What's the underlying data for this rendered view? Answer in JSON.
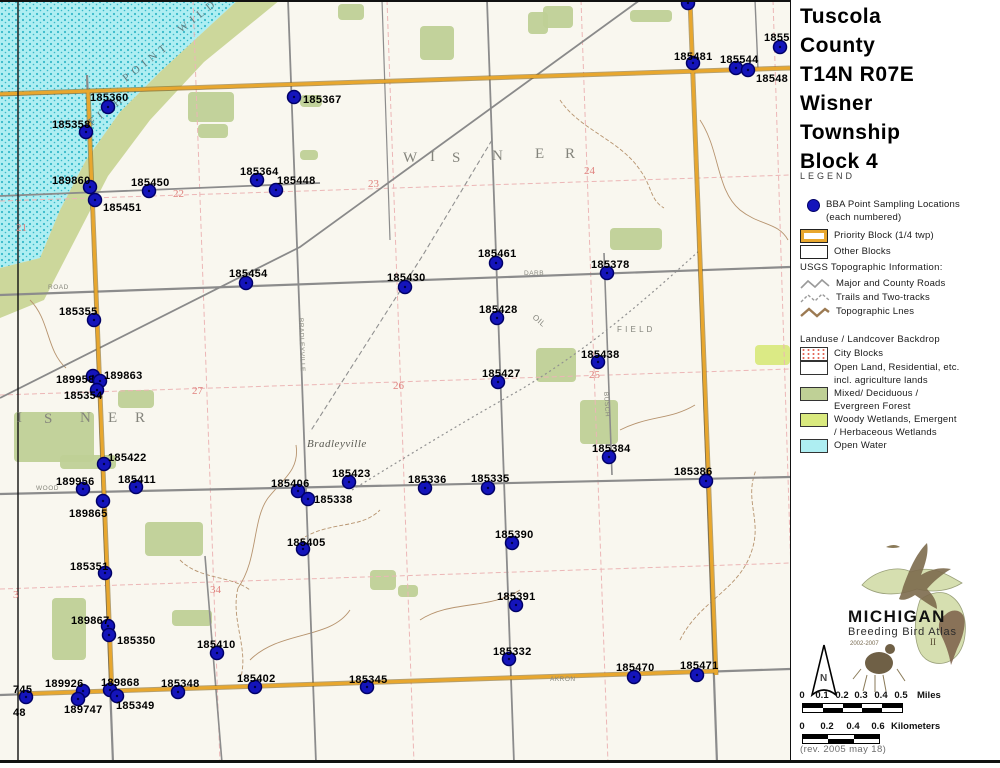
{
  "title": {
    "lines": [
      "Tuscola",
      "County",
      "T14N R07E",
      "Wisner",
      "Township",
      "Block 4"
    ]
  },
  "legend": {
    "heading": "LEGEND",
    "bba": {
      "l1": "BBA Point Sampling Locations",
      "l2": "(each numbered)"
    },
    "priority": "Priority Block (1/4 twp)",
    "other": "Other Blocks",
    "usgs": {
      "heading": "USGS Topographic Information:",
      "roads": "Major and County Roads",
      "trails": "Trails and Two-tracks",
      "topo": "Topographic Lnes"
    },
    "land": {
      "heading": "Landuse / Landcover Backdrop",
      "city": "City Blocks",
      "open1": "Open Land, Residential, etc.",
      "open2": "incl. agriculture lands",
      "mixed1": "Mixed/ Deciduous /",
      "mixed2": "Evergreen Forest",
      "woody1": "Woody Wetlands, Emergent",
      "woody2": "/ Herbaceous Wetlands",
      "water": "Open Water"
    }
  },
  "colors": {
    "dot": "#1414bb",
    "priority_border": "#e8a72e",
    "forest": "#bfd096",
    "wetland": "#d9e97e",
    "water": "#aeeef2"
  },
  "logo": {
    "name": "MICHIGAN",
    "sub": "Breeding Bird Atlas",
    "years": "2002-2007",
    "edition": "II"
  },
  "north": {
    "label": "N"
  },
  "scale": {
    "miles": {
      "labels": [
        "0",
        "0.1",
        "0.2",
        "0.3",
        "0.4",
        "0.5"
      ],
      "unit": "Miles"
    },
    "km": {
      "labels": [
        "0",
        "0.2",
        "0.4",
        "0.6"
      ],
      "unit": "Kilometers"
    }
  },
  "revision": "(rev. 2005 may 18)",
  "map": {
    "points": [
      {
        "id": "185360",
        "x": 108,
        "y": 107,
        "lx": 90,
        "ly": 101
      },
      {
        "id": "185358",
        "x": 86,
        "y": 132,
        "lx": 52,
        "ly": 128
      },
      {
        "id": "189860",
        "x": 90,
        "y": 187,
        "lx": 52,
        "ly": 184
      },
      {
        "id": "185450",
        "x": 149,
        "y": 191,
        "lx": 131,
        "ly": 186
      },
      {
        "id": "185451",
        "x": 95,
        "y": 200,
        "lx": 103,
        "ly": 211
      },
      {
        "id": "185364",
        "x": 257,
        "y": 180,
        "lx": 240,
        "ly": 175
      },
      {
        "id": "185448",
        "x": 276,
        "y": 190,
        "lx": 277,
        "ly": 184
      },
      {
        "id": "185367",
        "x": 294,
        "y": 97,
        "lx": 303,
        "ly": 103
      },
      {
        "id": "",
        "x": 688,
        "y": 3
      },
      {
        "id": "185481",
        "x": 693,
        "y": 63,
        "lx": 674,
        "ly": 60
      },
      {
        "id": "185544",
        "x": 736,
        "y": 68,
        "lx": 720,
        "ly": 63
      },
      {
        "id": "1855",
        "x": 780,
        "y": 47,
        "lx": 764,
        "ly": 41
      },
      {
        "id": "18548",
        "x": 748,
        "y": 70,
        "lx": 756,
        "ly": 82
      },
      {
        "id": "185454",
        "x": 246,
        "y": 283,
        "lx": 229,
        "ly": 277
      },
      {
        "id": "185355",
        "x": 94,
        "y": 320,
        "lx": 59,
        "ly": 315
      },
      {
        "id": "189958",
        "x": 93,
        "y": 376,
        "lx": 56,
        "ly": 383
      },
      {
        "id": "189863",
        "x": 100,
        "y": 381,
        "lx": 104,
        "ly": 379
      },
      {
        "id": "185354",
        "x": 97,
        "y": 390,
        "lx": 64,
        "ly": 399
      },
      {
        "id": "185422",
        "x": 104,
        "y": 464,
        "lx": 108,
        "ly": 461
      },
      {
        "id": "189956",
        "x": 83,
        "y": 489,
        "lx": 56,
        "ly": 485
      },
      {
        "id": "185411",
        "x": 136,
        "y": 487,
        "lx": 118,
        "ly": 483
      },
      {
        "id": "189865",
        "x": 103,
        "y": 501,
        "lx": 69,
        "ly": 517
      },
      {
        "id": "185406",
        "x": 298,
        "y": 491,
        "lx": 271,
        "ly": 487
      },
      {
        "id": "185338",
        "x": 308,
        "y": 499,
        "lx": 314,
        "ly": 503
      },
      {
        "id": "185405",
        "x": 303,
        "y": 549,
        "lx": 287,
        "ly": 546
      },
      {
        "id": "185351",
        "x": 105,
        "y": 573,
        "lx": 70,
        "ly": 570
      },
      {
        "id": "185423",
        "x": 349,
        "y": 482,
        "lx": 332,
        "ly": 477
      },
      {
        "id": "185336",
        "x": 425,
        "y": 488,
        "lx": 408,
        "ly": 483
      },
      {
        "id": "185335",
        "x": 488,
        "y": 488,
        "lx": 471,
        "ly": 482
      },
      {
        "id": "185390",
        "x": 512,
        "y": 543,
        "lx": 495,
        "ly": 538
      },
      {
        "id": "185391",
        "x": 516,
        "y": 605,
        "lx": 497,
        "ly": 600
      },
      {
        "id": "185332",
        "x": 509,
        "y": 659,
        "lx": 493,
        "ly": 655
      },
      {
        "id": "185345",
        "x": 367,
        "y": 687,
        "lx": 349,
        "ly": 683
      },
      {
        "id": "185348",
        "x": 178,
        "y": 692,
        "lx": 161,
        "ly": 687
      },
      {
        "id": "185402",
        "x": 255,
        "y": 687,
        "lx": 237,
        "ly": 682
      },
      {
        "id": "189926",
        "x": 83,
        "y": 691,
        "lx": 45,
        "ly": 687
      },
      {
        "id": "189868",
        "x": 110,
        "y": 690,
        "lx": 101,
        "ly": 686
      },
      {
        "id": "185349",
        "x": 117,
        "y": 696,
        "lx": 116,
        "ly": 709
      },
      {
        "id": "189747",
        "x": 78,
        "y": 699,
        "lx": 64,
        "ly": 713
      },
      {
        "id": "745",
        "x": 26,
        "y": 697,
        "lx": 13,
        "ly": 693
      },
      {
        "id": "48",
        "lx": 13,
        "ly": 716
      },
      {
        "id": "185410",
        "x": 217,
        "y": 653,
        "lx": 197,
        "ly": 648
      },
      {
        "id": "189867",
        "x": 108,
        "y": 626,
        "lx": 71,
        "ly": 624
      },
      {
        "id": "185350",
        "x": 109,
        "y": 635,
        "lx": 117,
        "ly": 644
      },
      {
        "id": "185378",
        "x": 607,
        "y": 273,
        "lx": 591,
        "ly": 268
      },
      {
        "id": "185461",
        "x": 496,
        "y": 263,
        "lx": 478,
        "ly": 257
      },
      {
        "id": "185430",
        "x": 405,
        "y": 287,
        "lx": 387,
        "ly": 281
      },
      {
        "id": "185428",
        "x": 497,
        "y": 318,
        "lx": 479,
        "ly": 313
      },
      {
        "id": "185427",
        "x": 498,
        "y": 382,
        "lx": 482,
        "ly": 377
      },
      {
        "id": "185438",
        "x": 598,
        "y": 362,
        "lx": 581,
        "ly": 358
      },
      {
        "id": "185384",
        "x": 609,
        "y": 457,
        "lx": 592,
        "ly": 452
      },
      {
        "id": "185386",
        "x": 706,
        "y": 481,
        "lx": 674,
        "ly": 475
      },
      {
        "id": "185470",
        "x": 634,
        "y": 677,
        "lx": 616,
        "ly": 671
      },
      {
        "id": "185471",
        "x": 697,
        "y": 675,
        "lx": 680,
        "ly": 669
      }
    ],
    "texts": [
      {
        "t": "W",
        "x": 403,
        "y": 162,
        "cls": "bigname"
      },
      {
        "t": "I",
        "x": 430,
        "y": 161,
        "cls": "bigname"
      },
      {
        "t": "S",
        "x": 452,
        "y": 162,
        "cls": "bigname"
      },
      {
        "t": "N",
        "x": 492,
        "y": 160,
        "cls": "bigname"
      },
      {
        "t": "E",
        "x": 535,
        "y": 158,
        "cls": "bigname"
      },
      {
        "t": "R",
        "x": 565,
        "y": 158,
        "cls": "bigname"
      },
      {
        "t": "I",
        "x": 17,
        "y": 422,
        "cls": "bigname"
      },
      {
        "t": "S",
        "x": 44,
        "y": 423,
        "cls": "bigname"
      },
      {
        "t": "N",
        "x": 80,
        "y": 422,
        "cls": "bigname"
      },
      {
        "t": "E",
        "x": 108,
        "y": 422,
        "cls": "bigname"
      },
      {
        "t": "R",
        "x": 135,
        "y": 422,
        "cls": "bigname"
      },
      {
        "t": "Bradleyville",
        "x": 307,
        "y": 447,
        "cls": "town"
      },
      {
        "t": "F I E L D",
        "x": 617,
        "y": 332,
        "cls": "micro2"
      },
      {
        "t": "OIL",
        "x": 532,
        "y": 318,
        "cls": "micro2",
        "rot": 40
      },
      {
        "t": "WOOD",
        "x": 36,
        "y": 490,
        "cls": "micro"
      },
      {
        "t": "ROAD",
        "x": 48,
        "y": 289,
        "cls": "micro"
      },
      {
        "t": "AKRON",
        "x": 550,
        "y": 681,
        "cls": "micro"
      },
      {
        "t": "DARB",
        "x": 524,
        "y": 275,
        "cls": "micro"
      },
      {
        "t": "BRADLEYVILLE",
        "x": 299,
        "y": 318,
        "cls": "micro",
        "rot": 88
      },
      {
        "t": "BUSCH",
        "x": 604,
        "y": 392,
        "cls": "micro",
        "rot": 86
      },
      {
        "t": "FISH",
        "x": 92,
        "y": 126,
        "cls": "shore",
        "rot": -38
      },
      {
        "t": "POINT",
        "x": 126,
        "y": 82,
        "cls": "shore",
        "rot": -38
      },
      {
        "t": "WILD",
        "x": 181,
        "y": 33,
        "cls": "shore",
        "rot": -38
      }
    ],
    "sections": [
      {
        "t": "21",
        "x": 16,
        "y": 231
      },
      {
        "t": "22",
        "x": 173,
        "y": 197
      },
      {
        "t": "23",
        "x": 368,
        "y": 187
      },
      {
        "t": "24",
        "x": 584,
        "y": 174
      },
      {
        "t": "25",
        "x": 589,
        "y": 378
      },
      {
        "t": "26",
        "x": 393,
        "y": 389
      },
      {
        "t": "27",
        "x": 192,
        "y": 394
      },
      {
        "t": "34",
        "x": 210,
        "y": 593
      },
      {
        "t": "3",
        "x": 13,
        "y": 598
      }
    ]
  }
}
